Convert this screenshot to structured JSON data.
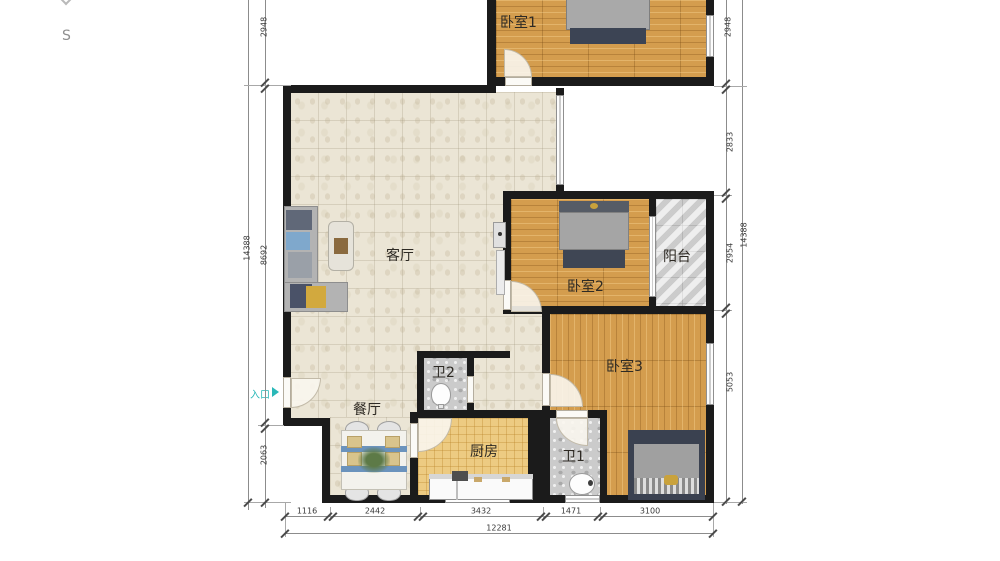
{
  "title": "apartment-floor-plan",
  "compass": {
    "south_label": "S"
  },
  "entrance": {
    "label": "入口"
  },
  "rooms": [
    {
      "id": "bedroom1",
      "label": "卧室1"
    },
    {
      "id": "living",
      "label": "客厅"
    },
    {
      "id": "bedroom2",
      "label": "卧室2"
    },
    {
      "id": "balcony",
      "label": "阳台"
    },
    {
      "id": "bedroom3",
      "label": "卧室3"
    },
    {
      "id": "bath2",
      "label": "卫2"
    },
    {
      "id": "dining",
      "label": "餐厅"
    },
    {
      "id": "kitchen",
      "label": "厨房"
    },
    {
      "id": "bath1",
      "label": "卫1"
    }
  ],
  "dimensions": {
    "left_outer": "14388",
    "left_inner": [
      "2948",
      "8692",
      "2063"
    ],
    "right_inner": [
      "2948",
      "2833",
      "2954",
      "5053"
    ],
    "right_outer": "14388",
    "bottom": [
      "1116",
      "2442",
      "3432",
      "1471",
      "3100"
    ],
    "bottom_total": "12281"
  },
  "colors": {
    "wall": "#1b1b1b",
    "wood": "#d49d4e",
    "tile_beige": "#ebe5d5",
    "kitchen_tile": "#edcb82",
    "bath_tile": "#cbcbcb",
    "balcony_tile": "#d9d9d9",
    "entrance_accent": "#2ab8b8",
    "dimension_text": "#3a3a3a"
  }
}
